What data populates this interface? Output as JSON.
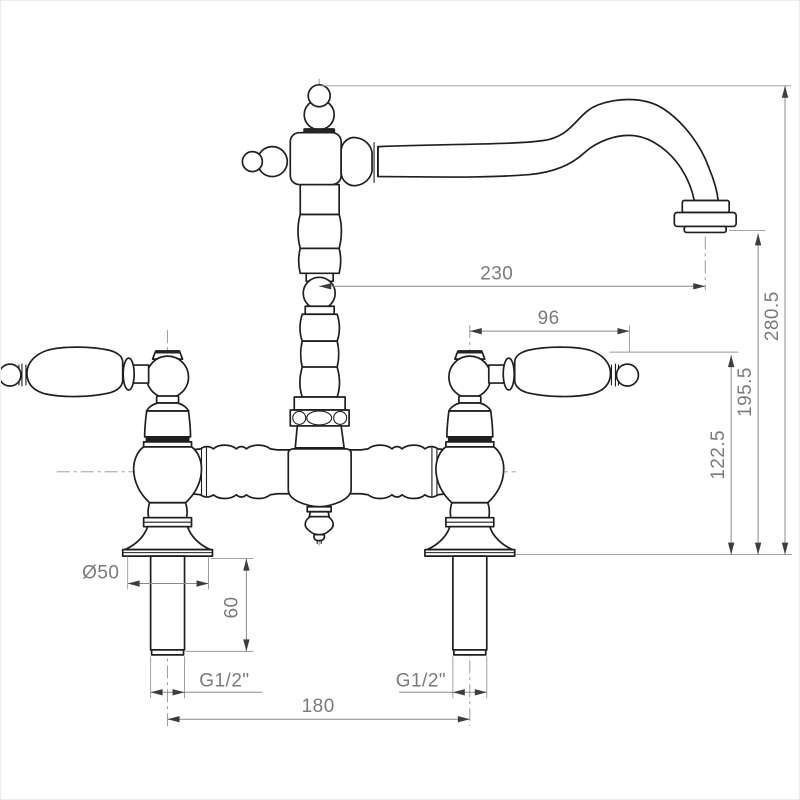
{
  "drawing": {
    "subject": "bridge two-handle kitchen mixer tap, front elevation technical drawing",
    "units": "mm",
    "background_color": "#ffffff",
    "outline_color": "#1f1f1f",
    "dimension_color": "#7a7a7a"
  },
  "dimensions": {
    "spout_reach": "230",
    "handle_span": "96",
    "overall_height": "280.5",
    "spout_outlet_height": "195.5",
    "handle_height": "122.5",
    "base_diameter": "Ø50",
    "shank_length": "60",
    "thread_left": "G1/2\"",
    "thread_right": "G1/2\"",
    "hole_centres": "180"
  }
}
